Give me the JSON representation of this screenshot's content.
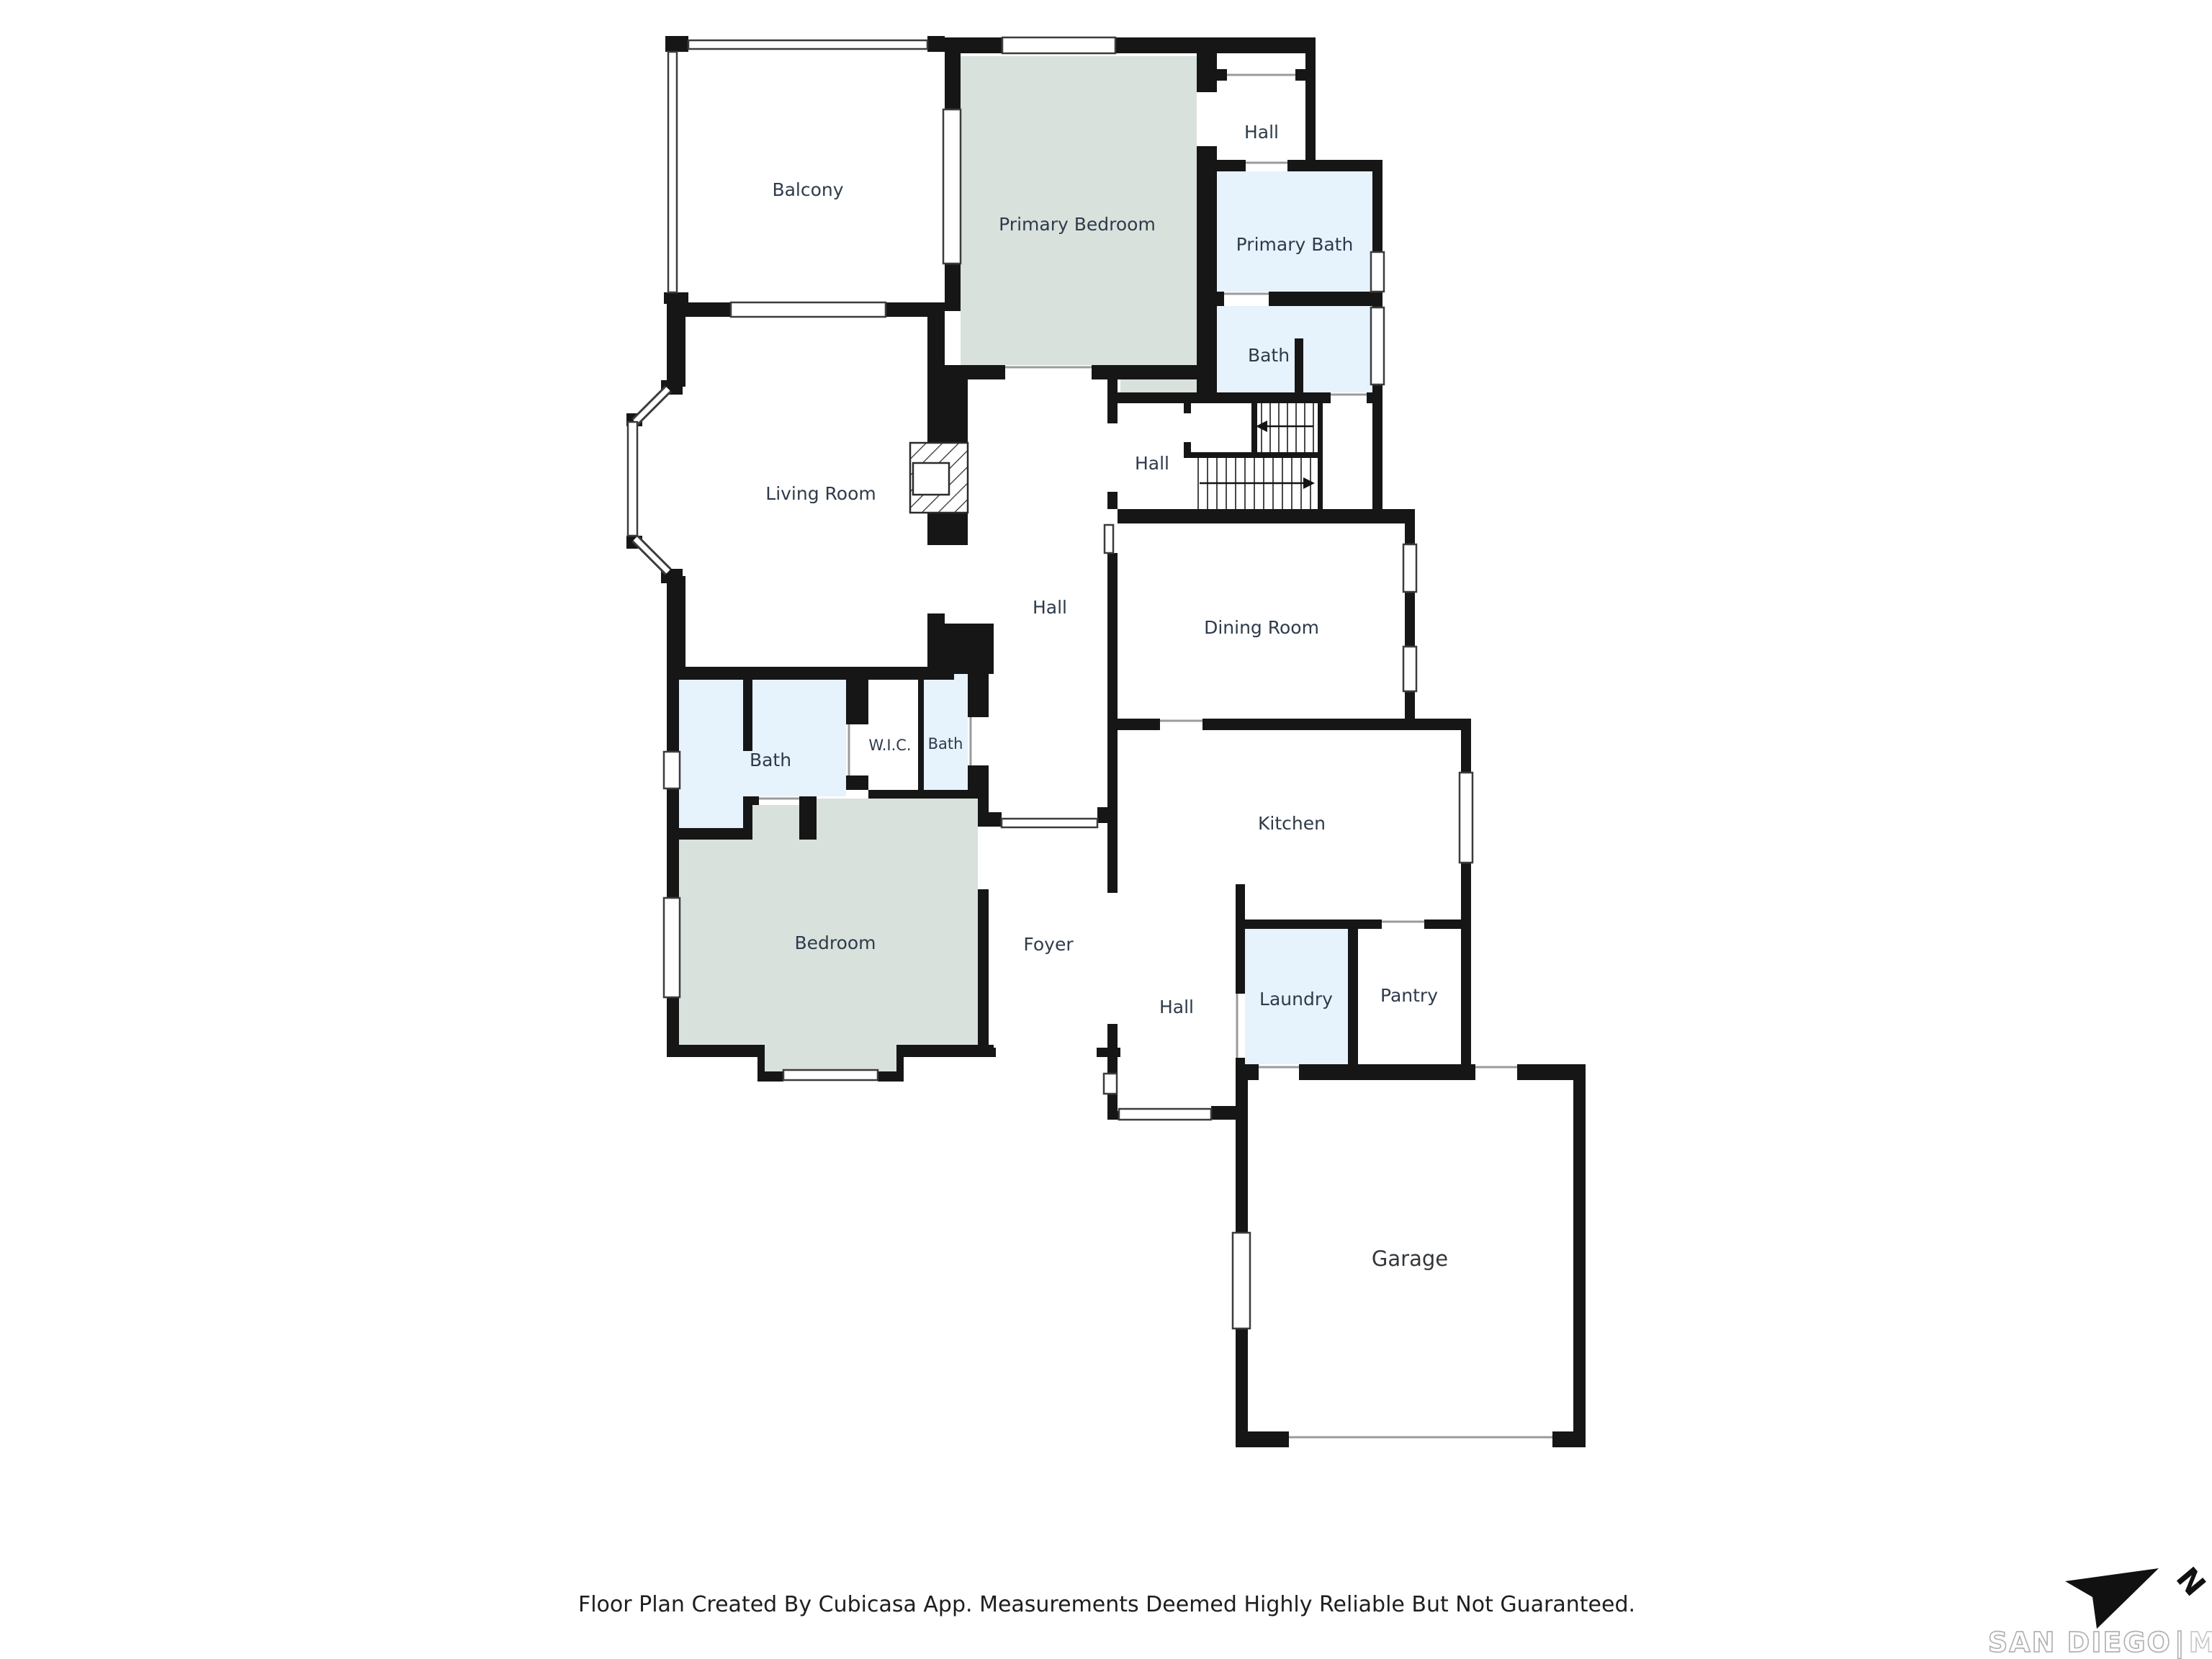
{
  "colors": {
    "wall": "#161616",
    "green": "#d9e1dc",
    "blue": "#e6f2fc",
    "label": "#2e3b4a"
  },
  "rooms": [
    {
      "id": "balcony",
      "label": "Balcony"
    },
    {
      "id": "primary-bedroom",
      "label": "Primary Bedroom"
    },
    {
      "id": "hall-upper",
      "label": "Hall"
    },
    {
      "id": "primary-bath",
      "label": "Primary Bath"
    },
    {
      "id": "bath-upper",
      "label": "Bath"
    },
    {
      "id": "living-room",
      "label": "Living Room"
    },
    {
      "id": "hall-stairs",
      "label": "Hall"
    },
    {
      "id": "hall-center",
      "label": "Hall"
    },
    {
      "id": "dining-room",
      "label": "Dining Room"
    },
    {
      "id": "bath-main",
      "label": "Bath"
    },
    {
      "id": "wic",
      "label": "W.I.C."
    },
    {
      "id": "bath-small",
      "label": "Bath"
    },
    {
      "id": "bedroom",
      "label": "Bedroom"
    },
    {
      "id": "foyer",
      "label": "Foyer"
    },
    {
      "id": "kitchen",
      "label": "Kitchen"
    },
    {
      "id": "hall-lower",
      "label": "Hall"
    },
    {
      "id": "laundry",
      "label": "Laundry"
    },
    {
      "id": "pantry",
      "label": "Pantry"
    },
    {
      "id": "garage",
      "label": "Garage"
    }
  ],
  "footer": {
    "disclaimer": "Floor Plan Created By Cubicasa App. Measurements Deemed Highly Reliable But Not Guaranteed."
  },
  "logo": {
    "north_label": "N",
    "brand": "SAN DIEGO",
    "divider": "|",
    "suffix": "MLS"
  }
}
